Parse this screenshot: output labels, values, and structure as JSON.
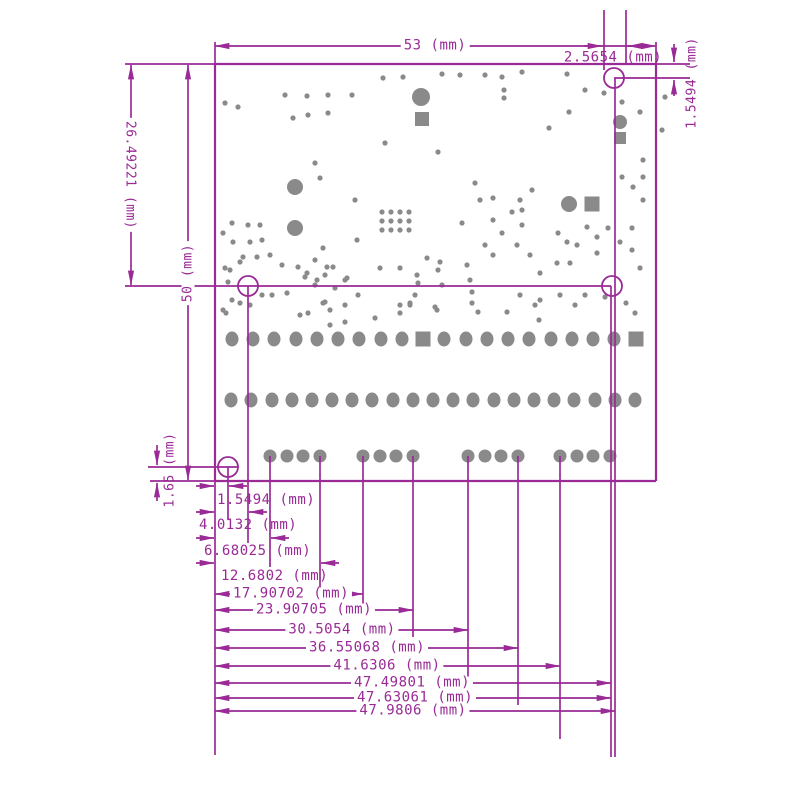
{
  "colors": {
    "line": "#992A96",
    "pad": "#8A8A8A",
    "background": "#FFFFFF"
  },
  "drawing": {
    "type": "pcb-dimension-drawing",
    "unit": "mm",
    "labels": {
      "board_width": "53 (mm)",
      "top_hole_offset_x": "2.5654 (mm)",
      "top_hole_offset_y": "1.5494 (mm)",
      "upper_section_height": "26.49221 (mm)",
      "board_height": "50 (mm)",
      "bottom_hole_offset_y": "1.65 (mm)",
      "bottom_stack": [
        "1.5494 (mm)",
        "4.0132 (mm)",
        "6.68025 (mm)",
        "12.6802 (mm)",
        "17.90702 (mm)",
        "23.90705 (mm)",
        "30.5054 (mm)",
        "36.55068 (mm)",
        "41.6306 (mm)",
        "47.49801 (mm)",
        "47.63061 (mm)",
        "47.9806 (mm)"
      ]
    }
  },
  "board": {
    "outline": {
      "x": 215,
      "y": 64,
      "width": 441,
      "height": 417
    },
    "mounting_holes": [
      [
        614,
        78
      ],
      [
        248,
        286
      ],
      [
        612,
        286
      ],
      [
        228,
        467
      ]
    ],
    "hole_radius": 10,
    "pad_row_top": {
      "y": 339,
      "xs": [
        232,
        253,
        274,
        296,
        317,
        338,
        359,
        381,
        402,
        423,
        444,
        466,
        487,
        508,
        529,
        551,
        572,
        593,
        614,
        636
      ],
      "square_indexes": [
        9,
        19
      ]
    },
    "pad_row_middle": {
      "y": 400,
      "xs": [
        231,
        251,
        272,
        292,
        312,
        332,
        352,
        372,
        393,
        413,
        433,
        453,
        473,
        494,
        514,
        534,
        554,
        574,
        595,
        615,
        635
      ]
    },
    "pad_row_bottom": {
      "y": 456,
      "xs": [
        270,
        287,
        303,
        320,
        363,
        380,
        396,
        413,
        468,
        485,
        501,
        518,
        560,
        577,
        593,
        610
      ]
    },
    "large_vias": [
      [
        295,
        187,
        8
      ],
      [
        295,
        228,
        8
      ],
      [
        421,
        97,
        9
      ],
      [
        620,
        122,
        7
      ],
      [
        569,
        204,
        8
      ]
    ],
    "square_pads": [
      [
        422,
        119,
        14
      ],
      [
        620,
        138,
        12
      ],
      [
        592,
        204,
        15
      ]
    ],
    "vias": [
      [
        225,
        103
      ],
      [
        238,
        107
      ],
      [
        285,
        95
      ],
      [
        307,
        96
      ],
      [
        328,
        95
      ],
      [
        352,
        95
      ],
      [
        293,
        118
      ],
      [
        308,
        115
      ],
      [
        328,
        113
      ],
      [
        383,
        78
      ],
      [
        403,
        77
      ],
      [
        442,
        74
      ],
      [
        460,
        75
      ],
      [
        485,
        75
      ],
      [
        502,
        77
      ],
      [
        522,
        72
      ],
      [
        567,
        74
      ],
      [
        585,
        90
      ],
      [
        604,
        93
      ],
      [
        504,
        90
      ],
      [
        504,
        98
      ],
      [
        622,
        102
      ],
      [
        640,
        112
      ],
      [
        569,
        112
      ],
      [
        665,
        97
      ],
      [
        662,
        130
      ],
      [
        549,
        128
      ],
      [
        315,
        163
      ],
      [
        320,
        178
      ],
      [
        355,
        200
      ],
      [
        385,
        143
      ],
      [
        438,
        152
      ],
      [
        357,
        240
      ],
      [
        323,
        248
      ],
      [
        475,
        183
      ],
      [
        480,
        200
      ],
      [
        493,
        198
      ],
      [
        512,
        212
      ],
      [
        522,
        210
      ],
      [
        532,
        190
      ],
      [
        522,
        225
      ],
      [
        493,
        220
      ],
      [
        502,
        233
      ],
      [
        462,
        223
      ],
      [
        485,
        245
      ],
      [
        493,
        255
      ],
      [
        517,
        245
      ],
      [
        530,
        255
      ],
      [
        558,
        233
      ],
      [
        567,
        242
      ],
      [
        540,
        273
      ],
      [
        557,
        263
      ],
      [
        570,
        263
      ],
      [
        597,
        253
      ],
      [
        577,
        245
      ],
      [
        587,
        227
      ],
      [
        597,
        237
      ],
      [
        608,
        228
      ],
      [
        620,
        242
      ],
      [
        632,
        250
      ],
      [
        632,
        228
      ],
      [
        643,
        200
      ],
      [
        633,
        187
      ],
      [
        643,
        177
      ],
      [
        622,
        177
      ],
      [
        643,
        160
      ],
      [
        520,
        200
      ],
      [
        232,
        223
      ],
      [
        223,
        233
      ],
      [
        248,
        225
      ],
      [
        260,
        225
      ],
      [
        233,
        242
      ],
      [
        250,
        242
      ],
      [
        262,
        240
      ],
      [
        243,
        257
      ],
      [
        257,
        257
      ],
      [
        270,
        255
      ],
      [
        225,
        268
      ],
      [
        282,
        265
      ],
      [
        298,
        267
      ],
      [
        240,
        262
      ],
      [
        230,
        270
      ],
      [
        228,
        282
      ],
      [
        232,
        300
      ],
      [
        226,
        313
      ],
      [
        250,
        305
      ],
      [
        262,
        295
      ],
      [
        287,
        293
      ],
      [
        272,
        295
      ],
      [
        305,
        277
      ],
      [
        315,
        260
      ],
      [
        315,
        285
      ],
      [
        327,
        267
      ],
      [
        333,
        267
      ],
      [
        335,
        288
      ],
      [
        347,
        278
      ],
      [
        380,
        268
      ],
      [
        400,
        268
      ],
      [
        417,
        275
      ],
      [
        418,
        283
      ],
      [
        427,
        258
      ],
      [
        440,
        262
      ],
      [
        438,
        270
      ],
      [
        442,
        285
      ],
      [
        467,
        265
      ],
      [
        470,
        280
      ],
      [
        323,
        303
      ],
      [
        358,
        295
      ],
      [
        415,
        295
      ],
      [
        410,
        305
      ],
      [
        435,
        307
      ],
      [
        472,
        292
      ],
      [
        472,
        303
      ],
      [
        330,
        310
      ],
      [
        330,
        325
      ],
      [
        345,
        322
      ],
      [
        375,
        318
      ],
      [
        400,
        305
      ],
      [
        307,
        273
      ],
      [
        317,
        280
      ],
      [
        325,
        275
      ],
      [
        345,
        280
      ],
      [
        520,
        295
      ],
      [
        540,
        300
      ],
      [
        560,
        295
      ],
      [
        575,
        305
      ],
      [
        585,
        295
      ],
      [
        605,
        297
      ],
      [
        640,
        268
      ],
      [
        223,
        310
      ],
      [
        240,
        303
      ],
      [
        300,
        315
      ],
      [
        308,
        313
      ],
      [
        325,
        302
      ],
      [
        345,
        305
      ],
      [
        410,
        303
      ],
      [
        400,
        313
      ],
      [
        437,
        310
      ],
      [
        478,
        312
      ],
      [
        507,
        312
      ],
      [
        535,
        305
      ],
      [
        539,
        320
      ],
      [
        626,
        303
      ],
      [
        635,
        313
      ],
      [
        382,
        212
      ],
      [
        391,
        212
      ],
      [
        400,
        212
      ],
      [
        409,
        212
      ],
      [
        382,
        221
      ],
      [
        391,
        221
      ],
      [
        400,
        221
      ],
      [
        409,
        221
      ],
      [
        382,
        230
      ],
      [
        391,
        230
      ],
      [
        400,
        230
      ],
      [
        409,
        230
      ]
    ]
  }
}
